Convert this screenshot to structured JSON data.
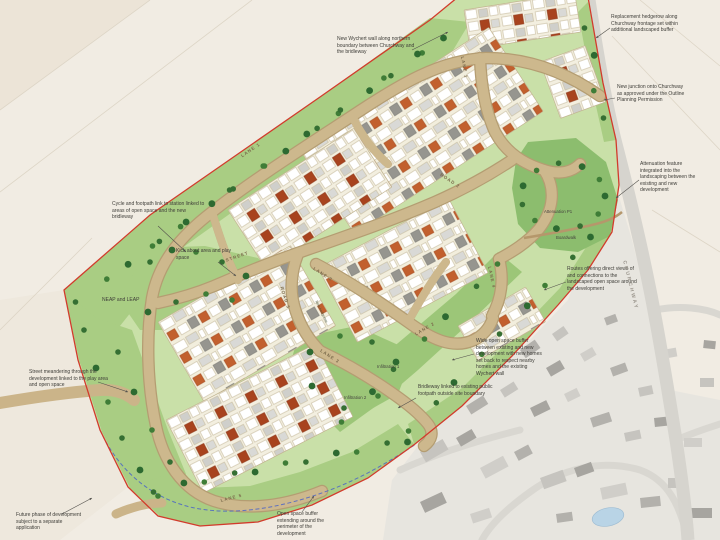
{
  "map": {
    "annotations": [
      {
        "id": "wychert-wall",
        "text": "New Wychert wall along northern boundary between Churchway and the bridleway"
      },
      {
        "id": "replacement-hedgerow",
        "text": "Replacement hedgerow along Churchway frontage set within additional landscaped buffer"
      },
      {
        "id": "new-junction",
        "text": "New junction onto Churchway as approved under the Outline Planning Permission"
      },
      {
        "id": "attenuation-feature",
        "text": "Attenuation feature integrated into the landscaping between the existing and new development"
      },
      {
        "id": "cycle-link",
        "text": "Cycle and footpath link to station linked to areas of open space and the new bridleway"
      },
      {
        "id": "kick-about",
        "text": "Kick about area and play space"
      },
      {
        "id": "neap-leap",
        "text": "NEAP and LEAP"
      },
      {
        "id": "street-meandering",
        "text": "Street meandering through the development linked to the play area and open space"
      },
      {
        "id": "future-phase",
        "text": "Future phase of development subject to a separate application"
      },
      {
        "id": "open-space-buffer",
        "text": "Open space buffer extending around the perimeter of the development"
      },
      {
        "id": "bridleway",
        "text": "Bridleway linked to existing public footpath outside site boundary"
      },
      {
        "id": "wide-buffer",
        "text": "Wide open space buffer between existing and new development with new homes set back to respect nearby homes and the existing Wychert wall"
      },
      {
        "id": "routes",
        "text": "Routes offering direct views of and connections to the landscaped open space around the development"
      },
      {
        "id": "attenuation-pond",
        "text": "Attenuation P1"
      },
      {
        "id": "boardwalk",
        "text": "Boardwalk"
      },
      {
        "id": "infiltration-1",
        "text": "Infiltration 1"
      },
      {
        "id": "infiltration-2",
        "text": "Infiltration 2"
      },
      {
        "id": "hedgerow-note",
        "text": "New hedgerow"
      }
    ],
    "road_labels": [
      {
        "id": "churchway",
        "text": "CHURCHWAY"
      },
      {
        "id": "lane1-top",
        "text": "LANE 1"
      },
      {
        "id": "lane1-west",
        "text": "LANE 1"
      },
      {
        "id": "road2",
        "text": "ROAD 2"
      },
      {
        "id": "street",
        "text": "STREET"
      },
      {
        "id": "road3",
        "text": "ROAD 3"
      },
      {
        "id": "lane2-upper",
        "text": "LANE 2"
      },
      {
        "id": "lane2-lower",
        "text": "LANE 2"
      },
      {
        "id": "lane3",
        "text": "LANE 3"
      },
      {
        "id": "lane4",
        "text": "LANE 4"
      },
      {
        "id": "lane5",
        "text": "LANE 5"
      }
    ],
    "colors": {
      "site_boundary": "#d23b2c",
      "open_space_buffer": "#a9cd83",
      "attenuation_green": "#8cbd6e",
      "internal_roads": "#c9b184",
      "existing_buildings": "#b3b1ac",
      "bridleway_line": "#4a63c8",
      "water": "#b9d4e6"
    }
  }
}
